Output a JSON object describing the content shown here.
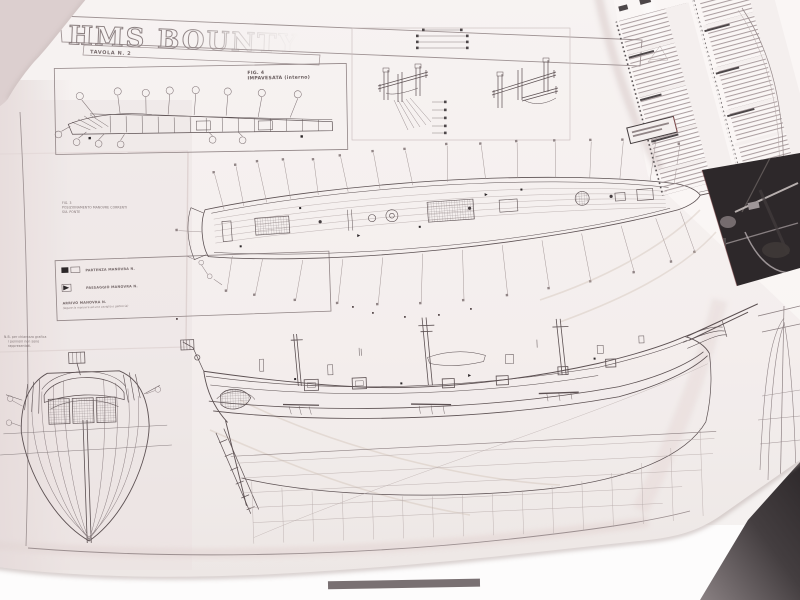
{
  "sheet": {
    "title": "HMS BOUNTY",
    "tavola_label": "TAVOLA N. 2",
    "fig4": {
      "fig_label": "FIG. 4",
      "caption": "IMPAVESATA (interno)"
    },
    "fig3": {
      "line1": "FIG. 3",
      "line2": "POSIZIONAMENTO MANOVRE CORRENTI",
      "line3": "SUL PONTE"
    },
    "legend": {
      "items": [
        {
          "symbol": "black-square",
          "label": "PARTENZA MANOVRA N."
        },
        {
          "symbol": "black-triangle",
          "label": "PASSAGGIO MANOVRA N."
        },
        {
          "symbol": "none",
          "label": "ARRIVO MANOVRA N.",
          "note": "(legare la manovra ad una caviglia o galloccia)"
        }
      ]
    },
    "nb_note": {
      "line1": "N.B. per chiarezza grafica",
      "line2": "i pennoni non sono",
      "line3": "rappresentati."
    },
    "drawings": {
      "deck_plan": "pianta del ponte con richiami numerati",
      "side_elevation": "profilo laterale dello scafo",
      "stern_view": "vista di poppa",
      "fife_rails": "dettagli cavigliere degli alberi",
      "parts_list": "elenco componenti (testo minuto)"
    },
    "colors": {
      "paper": "#f7f3f2",
      "paper_shadow": "#e6dbda",
      "ink": "#54494b",
      "ink_light": "#8a7e80",
      "black_accent": "#211d1f",
      "photo_inset_bg": "#221e20",
      "backdrop": "#f0ebe9",
      "dark_corner": "#2e292b"
    }
  }
}
